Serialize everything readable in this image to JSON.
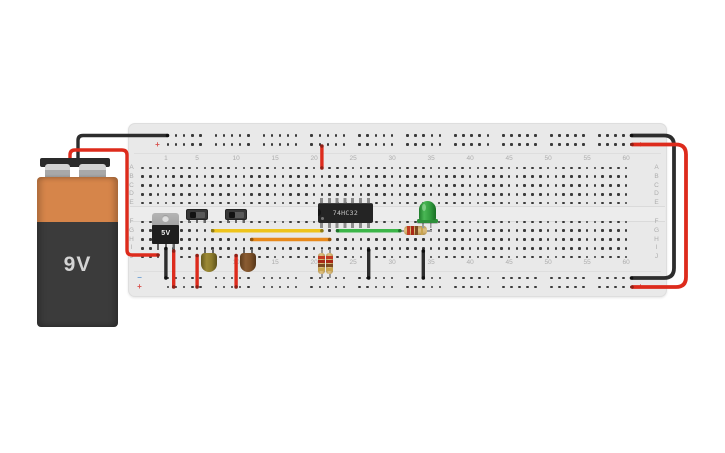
{
  "app": {
    "background": "#ffffff"
  },
  "battery": {
    "label": "9V",
    "colors": {
      "body": "#3b3b3b",
      "band": "#d6854a",
      "cap": "#2a2a2a",
      "terminal": "#a8a8a8",
      "text": "#d4d4d4"
    }
  },
  "breadboard": {
    "column_labels": [
      "1",
      "5",
      "10",
      "15",
      "20",
      "25",
      "30",
      "35",
      "40",
      "45",
      "50",
      "55",
      "60"
    ],
    "row_letters_top": [
      "A",
      "B",
      "C",
      "D",
      "E"
    ],
    "row_letters_bottom": [
      "F",
      "G",
      "H",
      "I",
      "J"
    ],
    "rail_negative_symbol": "−",
    "rail_positive_symbol": "+",
    "colors": {
      "board": "#e9e9e9",
      "hole": "#3a3a3a",
      "label": "#adadad",
      "minus": "#6b9fd4",
      "plus": "#d9534f"
    }
  },
  "components": {
    "regulator": {
      "label": "5V"
    },
    "ic": {
      "label": "74HC32"
    },
    "switches": [
      {
        "name": "slide-switch-1"
      },
      {
        "name": "slide-switch-2"
      }
    ],
    "capacitors": [
      {
        "name": "capacitor-1",
        "color": "#8d7c2d"
      },
      {
        "name": "capacitor-2",
        "color": "#7d5128"
      }
    ],
    "led": {
      "color": "#3aa845"
    },
    "resistors": {
      "body_color": "#d4b26e",
      "band_colors": [
        "#c23b22",
        "#a82817",
        "#7c4a21",
        "#c8a34e"
      ]
    }
  },
  "wires": {
    "colors": {
      "red": "#dd2b1c",
      "black": "#2d2d2d",
      "yellow": "#eec41c",
      "orange": "#e8891b",
      "green": "#3cb649"
    },
    "cap_colors": {
      "red": "#8f1f15",
      "black": "#0f0f0f",
      "yellow": "#8f7a12",
      "orange": "#8f5410",
      "green": "#1f7329"
    },
    "list": [
      {
        "id": "battery-neg-to-top-rail",
        "color": "black",
        "radius": 5,
        "width": 3.4,
        "points": [
          [
            78,
            163
          ],
          [
            78,
            135.5
          ],
          [
            167.5,
            135.5
          ]
        ]
      },
      {
        "id": "battery-pos-to-regulator-in",
        "color": "red",
        "radius": 5,
        "width": 3.4,
        "points": [
          [
            70,
            163
          ],
          [
            70,
            150
          ],
          [
            127,
            150
          ],
          [
            127,
            255
          ],
          [
            158.1,
            255
          ]
        ]
      },
      {
        "id": "top-rail-to-ic-vcc",
        "color": "red",
        "radius": 4,
        "width": 3.4,
        "points": [
          [
            321.9,
            146
          ],
          [
            321.9,
            168
          ]
        ]
      },
      {
        "id": "regulator-gnd-to-bottom-neg",
        "color": "black",
        "radius": 4,
        "width": 3.4,
        "points": [
          [
            165.9,
            248.5
          ],
          [
            165.9,
            278
          ]
        ]
      },
      {
        "id": "regulator-out-to-bottom-pos",
        "color": "red",
        "radius": 4,
        "width": 3.4,
        "points": [
          [
            173.7,
            251
          ],
          [
            173.7,
            287
          ]
        ]
      },
      {
        "id": "switch1-common-to-bottom-pos",
        "color": "red",
        "radius": 4,
        "width": 3.4,
        "points": [
          [
            197.1,
            255.5
          ],
          [
            197.1,
            287
          ]
        ]
      },
      {
        "id": "switch2-common-to-bottom-pos",
        "color": "red",
        "radius": 4,
        "width": 3.4,
        "points": [
          [
            236.1,
            255.5
          ],
          [
            236.1,
            287
          ]
        ]
      },
      {
        "id": "cap1-to-ic-input-1a",
        "color": "yellow",
        "radius": 4,
        "width": 3.4,
        "points": [
          [
            212.7,
            230.75
          ],
          [
            321.9,
            230.75
          ]
        ]
      },
      {
        "id": "cap2-to-ic-input-1b",
        "color": "orange",
        "radius": 4,
        "width": 3.4,
        "points": [
          [
            251.7,
            239.5
          ],
          [
            329.7,
            239.5
          ]
        ]
      },
      {
        "id": "ic-output-to-resistor",
        "color": "green",
        "radius": 4,
        "width": 3.4,
        "points": [
          [
            337.5,
            230.75
          ],
          [
            399.9,
            230.75
          ]
        ]
      },
      {
        "id": "ic-gnd-to-bottom-neg",
        "color": "black",
        "radius": 4,
        "width": 3.4,
        "points": [
          [
            368.7,
            250
          ],
          [
            368.7,
            278
          ]
        ]
      },
      {
        "id": "led-cathode-to-bottom-neg",
        "color": "black",
        "radius": 4,
        "width": 3.4,
        "points": [
          [
            423.3,
            251
          ],
          [
            423.3,
            278
          ]
        ]
      },
      {
        "id": "right-wrap-neg",
        "color": "black",
        "radius": 10,
        "width": 3.8,
        "points": [
          [
            631.5,
            135.5
          ],
          [
            674,
            135.5
          ],
          [
            674,
            278
          ],
          [
            631.5,
            278
          ]
        ]
      },
      {
        "id": "right-wrap-pos",
        "color": "red",
        "radius": 10,
        "width": 3.8,
        "points": [
          [
            632,
            144.5
          ],
          [
            686,
            144.5
          ],
          [
            686,
            287
          ],
          [
            632,
            287
          ]
        ]
      }
    ]
  }
}
